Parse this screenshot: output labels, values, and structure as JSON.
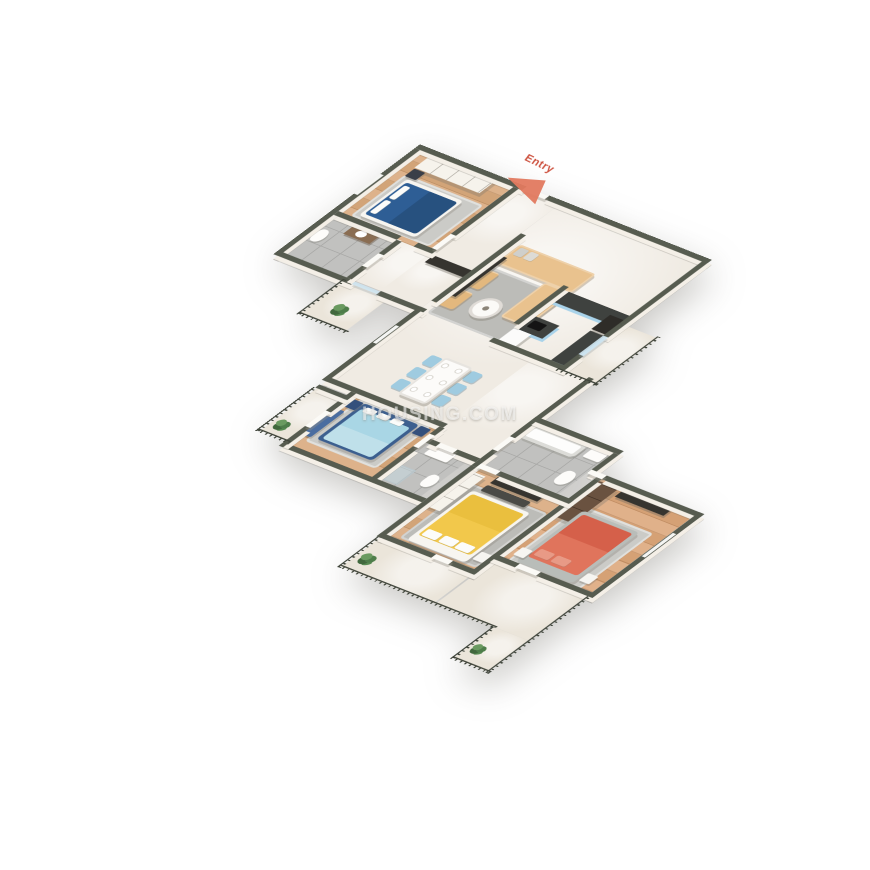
{
  "scene": {
    "type": "isometric-3d-floor-plan-render",
    "background": "#ffffff",
    "description": "3BHK/4BHK apartment 3D floor plan, top-down isometric cutaway"
  },
  "watermark": {
    "text": "HOUSING.COM"
  },
  "entry_marker": {
    "label": "Entry"
  },
  "palette": {
    "bg": "#ffffff",
    "wall": "#575c50",
    "wallface": "#f4efe7",
    "rail": "#3e4339",
    "wood": "#ddb28b",
    "woodline": "#d2a478",
    "marble": "#f0ebe3",
    "tile": "#c1c1bf",
    "tileline": "#a9a9a7",
    "balcfloor": "#ebe5da",
    "rug": "#bcbcb8",
    "bedblue": "#2e5e95",
    "bedbluedark": "#27517f",
    "lblue": "#a9d6e5",
    "blueframe": "#3c5f8f",
    "yellow": "#f2c84b",
    "coral": "#e0745c",
    "coraldark": "#d5604a",
    "sofa": "#e9c28e",
    "tan": "#e3b87e",
    "kblue": "#a9d3ea",
    "counter": "#3f423f",
    "brown": "#6a5240",
    "dchair": "#9fcbe0",
    "doorcol": "#fbfaf6",
    "glasscol": "#cfe4ef",
    "plant": "#4e7d4a",
    "entry": "#e2795f"
  },
  "rooms": [
    {
      "id": "bedroom-1",
      "floor": "wood",
      "furniture": [
        "dark-blue-double-bed",
        "wardrobe",
        "nightstand",
        "rug"
      ]
    },
    {
      "id": "bathroom-1",
      "floor": "gray-tile",
      "furniture": [
        "toilet",
        "vanity-washbasin"
      ]
    },
    {
      "id": "entry-foyer",
      "floor": "marble",
      "furniture": []
    },
    {
      "id": "living-dining-hall",
      "floor": "marble",
      "furniture": [
        "beige-l-sofa",
        "two-tan-armchairs",
        "round-coffee-table",
        "tv-console",
        "dining-table-6-blue-chairs",
        "gray-rug"
      ]
    },
    {
      "id": "kitchen",
      "floor": "marble",
      "furniture": [
        "blue-counter-run",
        "blue-island-cooktop",
        "blue-side-counter",
        "tall-dark-unit",
        "fridge"
      ]
    },
    {
      "id": "bedroom-2",
      "floor": "wood",
      "furniture": [
        "light-blue-double-bed",
        "blue-bench",
        "two-nightstands",
        "rug"
      ]
    },
    {
      "id": "ensuite-bathroom-2",
      "floor": "gray-tile",
      "furniture": [
        "vanity-washbasin",
        "toilet",
        "shower"
      ]
    },
    {
      "id": "common-bathroom-3",
      "floor": "gray-tile",
      "furniture": [
        "bathtub",
        "toilet",
        "washbasin"
      ]
    },
    {
      "id": "bedroom-3",
      "floor": "wood",
      "furniture": [
        "yellow-double-bed",
        "tv-console",
        "white-wardrobe",
        "dark-bench",
        "rug"
      ]
    },
    {
      "id": "bedroom-4",
      "floor": "wood",
      "furniture": [
        "coral-double-bed",
        "brown-wardrobe",
        "tv-console",
        "two-white-nightstands",
        "rug"
      ]
    },
    {
      "id": "balcony-top-left",
      "floor": "stone",
      "furniture": [
        "plant"
      ]
    },
    {
      "id": "balcony-right",
      "floor": "stone",
      "furniture": []
    },
    {
      "id": "balcony-left",
      "floor": "stone",
      "furniture": [
        "plant"
      ]
    },
    {
      "id": "balcony-bottom-terrace",
      "floor": "stone",
      "furniture": [
        "plant",
        "plant"
      ]
    }
  ]
}
